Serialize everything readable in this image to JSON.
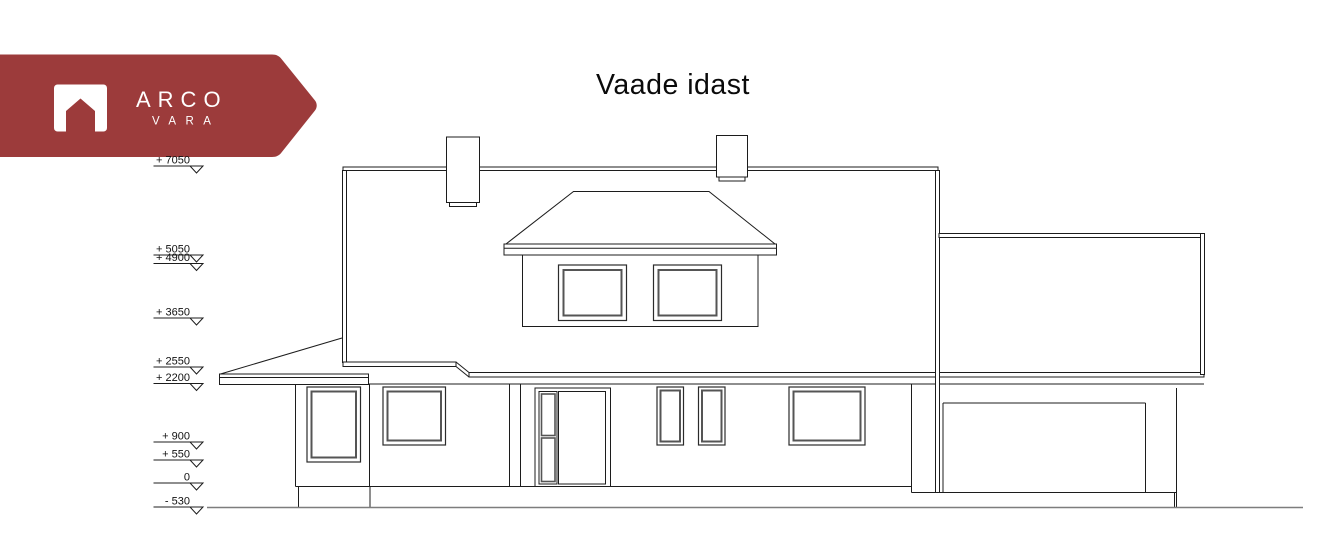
{
  "logo": {
    "brand": "ARCO",
    "subbrand": "VARA",
    "icon": "house-icon"
  },
  "title": "Vaade idast",
  "colors": {
    "brand_red": "#9c3b3b",
    "line": "#1c1c1c",
    "ground": "#7d7d7d"
  },
  "elevation_markers": [
    {
      "label": "+ 7050",
      "y": 166
    },
    {
      "label": "+ 5050",
      "y": 255
    },
    {
      "label": "+ 4900",
      "y": 263.5
    },
    {
      "label": "+ 3650",
      "y": 318
    },
    {
      "label": "+ 2550",
      "y": 367
    },
    {
      "label": "+ 2200",
      "y": 383.5
    },
    {
      "label": "+ 900",
      "y": 442
    },
    {
      "label": "+ 550",
      "y": 460
    },
    {
      "label": "0",
      "y": 483
    },
    {
      "label": "- 530",
      "y": 507
    }
  ]
}
